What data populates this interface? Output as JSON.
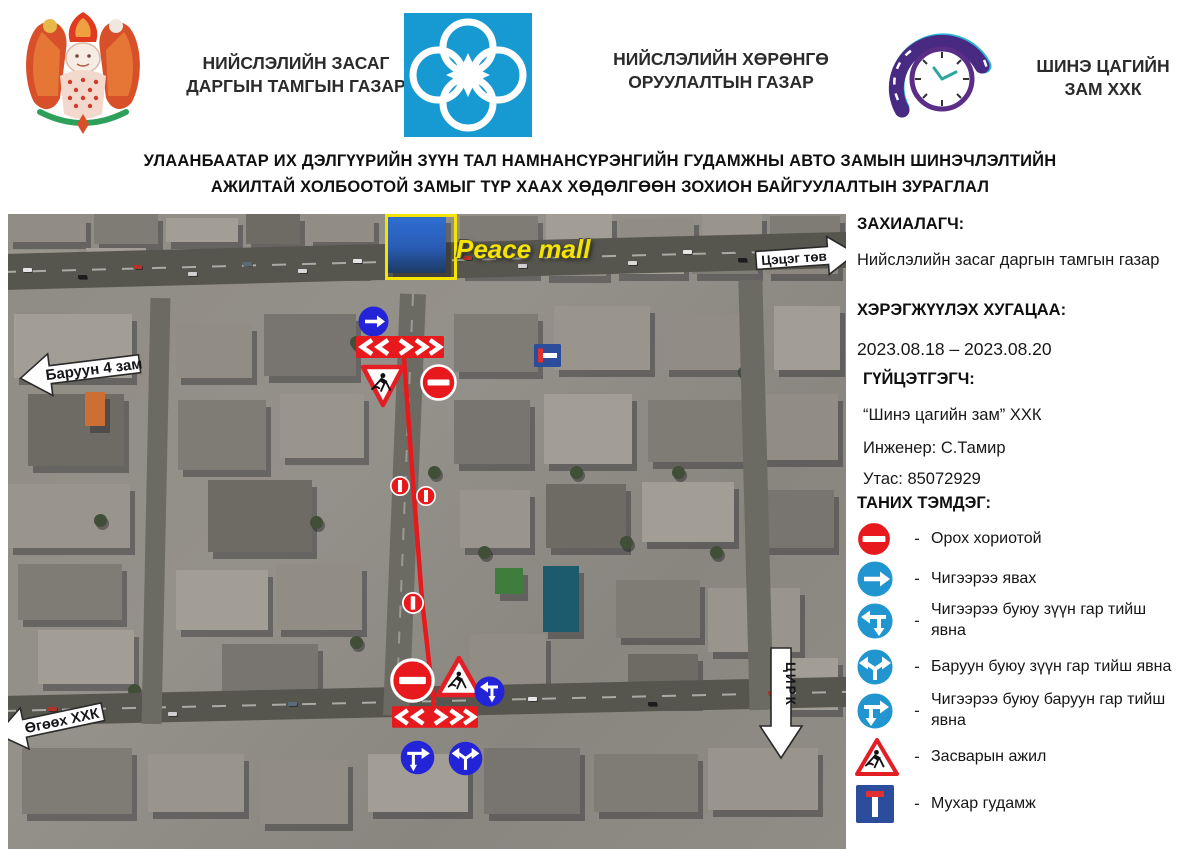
{
  "header": {
    "org1": {
      "line1": "НИЙСЛЭЛИЙН ЗАСАГ",
      "line2": "ДАРГЫН ТАМГЫН ГАЗАР"
    },
    "org2": {
      "line1": "НИЙСЛЭЛИЙН ХӨРӨНГӨ",
      "line2": "ОРУУЛАЛТЫН ГАЗАР"
    },
    "org3": {
      "line1": "ШИНЭ ЦАГИЙН",
      "line2": "ЗАМ ХХК"
    }
  },
  "title": {
    "line1": "УЛААНБААТАР ИХ ДЭЛГҮҮРИЙН ЗҮҮН ТАЛ НАМНАНСҮРЭНГИЙН ГУДАМЖНЫ АВТО ЗАМЫН ШИНЭЧЛЭЛТИЙН",
    "line2": "АЖИЛТАЙ ХОЛБООТОЙ ЗАМЫГ ТҮР ХААХ ХӨДӨЛГӨӨН ЗОХИОН БАЙГУУЛАЛТЫН ЗУРАГЛАЛ"
  },
  "map": {
    "peace_mall": "Peace mall",
    "arrow_west": "Баруун 4 зам",
    "arrow_east": "Цэцэг төв",
    "arrow_southwest": "Өгөөх ХХК",
    "arrow_circus": "ЦИРК"
  },
  "info": {
    "customer_label": "ЗАХИАЛАГЧ:",
    "customer": "Нийслэлийн засаг даргын тамгын газар",
    "period_label": "ХЭРЭГЖҮҮЛЭХ ХУГАЦАА:",
    "period": "2023.08.18 – 2023.08.20",
    "executor_label": "ГҮЙЦЭТГЭГЧ:",
    "executor": "“Шинэ цагийн зам” ХХК",
    "engineer": "Инженер: С.Тамир",
    "phone": "Утас: 85072929",
    "legend_label": "ТАНИХ ТЭМДЭГ:"
  },
  "legend": {
    "dash": "-",
    "items": [
      {
        "icon": "no-entry-icon",
        "label": "Орох хориотой"
      },
      {
        "icon": "go-straight-icon",
        "label": "Чигээрээ явах"
      },
      {
        "icon": "straight-or-left-icon",
        "label": "Чигээрээ буюу зүүн гар тийш явна"
      },
      {
        "icon": "left-or-right-icon",
        "label": "Баруун буюу зүүн гар тийш явна"
      },
      {
        "icon": "straight-or-right-icon",
        "label": "Чигээрээ буюу баруун гар тийш явна"
      },
      {
        "icon": "roadwork-icon",
        "label": "Засварын ажил"
      },
      {
        "icon": "dead-end-icon",
        "label": "Мухар гудамж"
      }
    ]
  },
  "colors": {
    "accent_red": "#e8191c",
    "legend_blue": "#2095cf",
    "map_sign_blue": "#2323d8",
    "dead_end_blue": "#2b4d9c",
    "highlight_yellow": "#f5e400"
  }
}
